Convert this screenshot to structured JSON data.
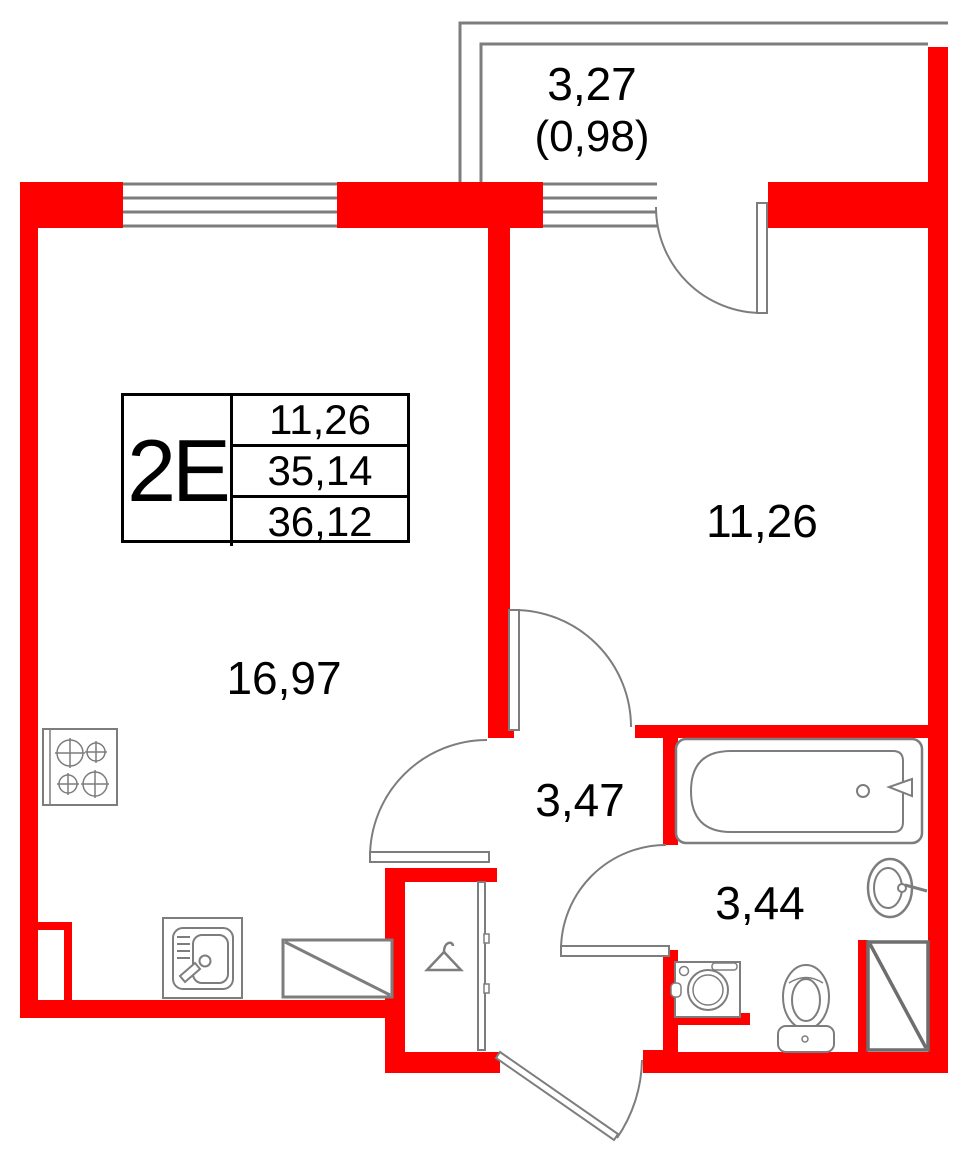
{
  "unit": {
    "type_label": "2Е",
    "rooms_area": "11,26",
    "living_area": "35,14",
    "total_area": "36,12"
  },
  "rooms": {
    "balcony": {
      "area": "3,27",
      "area_with_coeff": "(0,98)"
    },
    "living_kitchen": {
      "area": "16,97"
    },
    "bedroom": {
      "area": "11,26"
    },
    "hall": {
      "area": "3,47"
    },
    "bathroom": {
      "area": "3,44"
    }
  },
  "colors": {
    "wall": "#ff0000",
    "drawing_line": "#7d7d7d",
    "text": "#000000"
  }
}
